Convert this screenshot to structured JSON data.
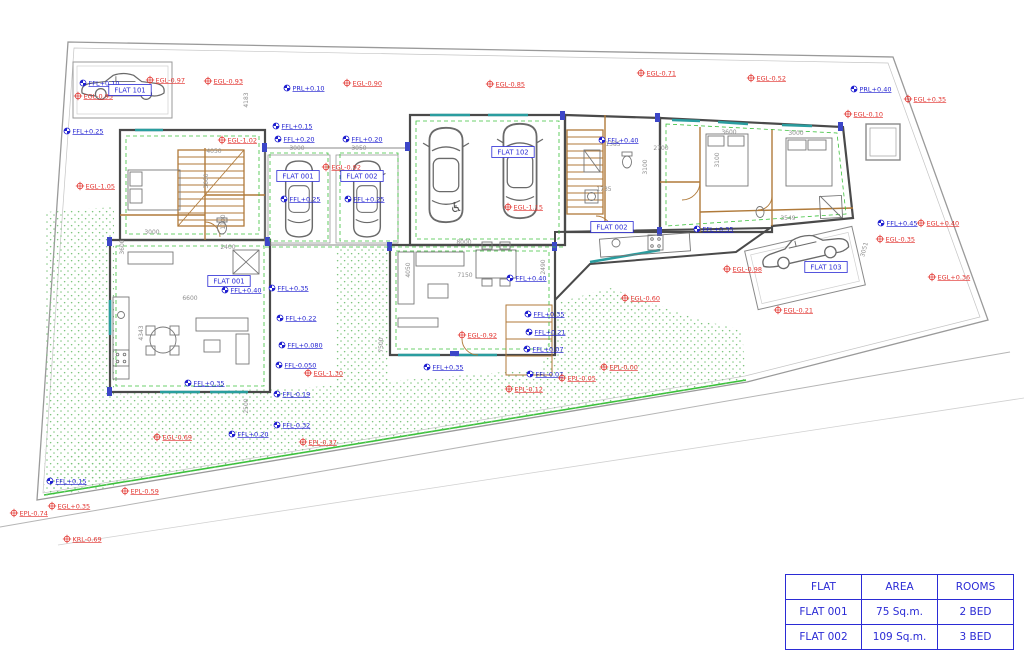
{
  "colors": {
    "marker_red": "#e23530",
    "marker_blue": "#1f1fd0",
    "tag_blue": "#2b2bd5",
    "dim_gray": "#8f8f8f",
    "wall": "#4a4a4a",
    "wood": "#b07a3a",
    "green": "#3cc13c",
    "teal": "#2a9d9f",
    "frame_blue": "#3c46c8",
    "stipple_green": "#7cc47c",
    "boundary_gray": "#9a9a9a",
    "furniture_gray": "#777777"
  },
  "markers": [
    {
      "x": 83,
      "y": 83,
      "label": "FFL+0.10",
      "type": "blue"
    },
    {
      "x": 150,
      "y": 80,
      "label": "EGL-0.97",
      "type": "red"
    },
    {
      "x": 208,
      "y": 81,
      "label": "EGL-0.93",
      "type": "red"
    },
    {
      "x": 78,
      "y": 96,
      "label": "EGL-0.95",
      "type": "red"
    },
    {
      "x": 287,
      "y": 88,
      "label": "PRL+0.10",
      "type": "blue"
    },
    {
      "x": 347,
      "y": 83,
      "label": "EGL-0.90",
      "type": "red"
    },
    {
      "x": 490,
      "y": 84,
      "label": "EGL-0.85",
      "type": "red"
    },
    {
      "x": 641,
      "y": 73,
      "label": "EGL-0.71",
      "type": "red"
    },
    {
      "x": 751,
      "y": 78,
      "label": "EGL-0.52",
      "type": "red"
    },
    {
      "x": 854,
      "y": 89,
      "label": "PRL+0.40",
      "type": "blue"
    },
    {
      "x": 908,
      "y": 99,
      "label": "EGL+0.35",
      "type": "red"
    },
    {
      "x": 848,
      "y": 114,
      "label": "EGL-0.10",
      "type": "red"
    },
    {
      "x": 67,
      "y": 131,
      "label": "FFL+0.25",
      "type": "blue"
    },
    {
      "x": 80,
      "y": 186,
      "label": "EGL-1.05",
      "type": "red"
    },
    {
      "x": 222,
      "y": 140,
      "label": "EGL-1.02",
      "type": "red"
    },
    {
      "x": 276,
      "y": 126,
      "label": "FFL+0.15",
      "type": "blue"
    },
    {
      "x": 278,
      "y": 139,
      "label": "FFL+0.20",
      "type": "blue"
    },
    {
      "x": 346,
      "y": 139,
      "label": "FFL+0.20",
      "type": "blue"
    },
    {
      "x": 326,
      "y": 167,
      "label": "EGL-0.92",
      "type": "red"
    },
    {
      "x": 284,
      "y": 199,
      "label": "FFL+0.25",
      "type": "blue"
    },
    {
      "x": 348,
      "y": 199,
      "label": "FFL+0.25",
      "type": "blue"
    },
    {
      "x": 508,
      "y": 207,
      "label": "EGL-1.15",
      "type": "red"
    },
    {
      "x": 602,
      "y": 140,
      "label": "FFL+0.40",
      "type": "blue"
    },
    {
      "x": 510,
      "y": 278,
      "label": "FFL+0.40",
      "type": "blue"
    },
    {
      "x": 272,
      "y": 288,
      "label": "FFL+0.35",
      "type": "blue"
    },
    {
      "x": 225,
      "y": 290,
      "label": "FFL+0.40",
      "type": "blue"
    },
    {
      "x": 280,
      "y": 318,
      "label": "FFL+0.22",
      "type": "blue"
    },
    {
      "x": 282,
      "y": 345,
      "label": "FFL+0.080",
      "type": "blue"
    },
    {
      "x": 279,
      "y": 365,
      "label": "FFL-0.050",
      "type": "blue"
    },
    {
      "x": 308,
      "y": 373,
      "label": "EGL-1.30",
      "type": "red"
    },
    {
      "x": 188,
      "y": 383,
      "label": "FFL+0.35",
      "type": "blue"
    },
    {
      "x": 277,
      "y": 394,
      "label": "FFL-0.19",
      "type": "blue"
    },
    {
      "x": 277,
      "y": 425,
      "label": "FFL-0.32",
      "type": "blue"
    },
    {
      "x": 303,
      "y": 442,
      "label": "EPL-0.37",
      "type": "red"
    },
    {
      "x": 232,
      "y": 434,
      "label": "FFL+0.20",
      "type": "blue"
    },
    {
      "x": 157,
      "y": 437,
      "label": "EGL-0.69",
      "type": "red"
    },
    {
      "x": 50,
      "y": 481,
      "label": "FFL+0.15",
      "type": "blue"
    },
    {
      "x": 52,
      "y": 506,
      "label": "EGL+0.35",
      "type": "red"
    },
    {
      "x": 14,
      "y": 513,
      "label": "EPL-0.74",
      "type": "red"
    },
    {
      "x": 125,
      "y": 491,
      "label": "EPL-0.59",
      "type": "red"
    },
    {
      "x": 67,
      "y": 539,
      "label": "KRL-0.69",
      "type": "red"
    },
    {
      "x": 427,
      "y": 367,
      "label": "FFL+0.35",
      "type": "blue"
    },
    {
      "x": 462,
      "y": 335,
      "label": "EGL-0.92",
      "type": "red"
    },
    {
      "x": 528,
      "y": 314,
      "label": "FFL+0.35",
      "type": "blue"
    },
    {
      "x": 529,
      "y": 332,
      "label": "FFL+0.21",
      "type": "blue"
    },
    {
      "x": 527,
      "y": 349,
      "label": "FFL+0.07",
      "type": "blue"
    },
    {
      "x": 530,
      "y": 374,
      "label": "FFL-0.07",
      "type": "blue"
    },
    {
      "x": 562,
      "y": 378,
      "label": "EPL-0.05",
      "type": "red"
    },
    {
      "x": 604,
      "y": 367,
      "label": "EPL-0.00",
      "type": "red"
    },
    {
      "x": 509,
      "y": 389,
      "label": "EPL-0.12",
      "type": "red"
    },
    {
      "x": 625,
      "y": 298,
      "label": "EGL-0.60",
      "type": "red"
    },
    {
      "x": 697,
      "y": 229,
      "label": "FFL+0.35",
      "type": "blue"
    },
    {
      "x": 881,
      "y": 223,
      "label": "FFL+0.45",
      "type": "blue"
    },
    {
      "x": 921,
      "y": 223,
      "label": "EGL+0.40",
      "type": "red"
    },
    {
      "x": 880,
      "y": 239,
      "label": "EGL-0.35",
      "type": "red"
    },
    {
      "x": 932,
      "y": 277,
      "label": "EGL+0.36",
      "type": "red"
    },
    {
      "x": 727,
      "y": 269,
      "label": "EGL-0.98",
      "type": "red"
    },
    {
      "x": 778,
      "y": 310,
      "label": "EGL-0.21",
      "type": "red"
    }
  ],
  "flat_tags": [
    {
      "x": 130,
      "y": 90,
      "label": "FLAT 101"
    },
    {
      "x": 298,
      "y": 176,
      "label": "FLAT 001"
    },
    {
      "x": 362,
      "y": 176,
      "label": "FLAT 002"
    },
    {
      "x": 513,
      "y": 152,
      "label": "FLAT 102"
    },
    {
      "x": 229,
      "y": 281,
      "label": "FLAT 001"
    },
    {
      "x": 612,
      "y": 227,
      "label": "FLAT 002"
    },
    {
      "x": 826,
      "y": 267,
      "label": "FLAT 103"
    }
  ],
  "dims": [
    {
      "x": 248,
      "y": 100,
      "label": "4183",
      "rot": 90
    },
    {
      "x": 214,
      "y": 153,
      "label": "4050",
      "rot": 0
    },
    {
      "x": 208,
      "y": 181,
      "label": "3600",
      "rot": 90
    },
    {
      "x": 297,
      "y": 150,
      "label": "3000",
      "rot": 0
    },
    {
      "x": 359,
      "y": 150,
      "label": "3050",
      "rot": 0
    },
    {
      "x": 152,
      "y": 234,
      "label": "3000",
      "rot": 0
    },
    {
      "x": 124,
      "y": 247,
      "label": "3600",
      "rot": 90
    },
    {
      "x": 143,
      "y": 333,
      "label": "4343",
      "rot": 90
    },
    {
      "x": 190,
      "y": 300,
      "label": "6600",
      "rot": 0
    },
    {
      "x": 228,
      "y": 249,
      "label": "2400",
      "rot": 0
    },
    {
      "x": 225,
      "y": 222,
      "label": "1100",
      "rot": 90
    },
    {
      "x": 464,
      "y": 244,
      "label": "8000",
      "rot": 0
    },
    {
      "x": 465,
      "y": 277,
      "label": "7150",
      "rot": 0
    },
    {
      "x": 410,
      "y": 270,
      "label": "4050",
      "rot": 90
    },
    {
      "x": 545,
      "y": 267,
      "label": "2490",
      "rot": 90
    },
    {
      "x": 383,
      "y": 345,
      "label": "7500",
      "rot": 90
    },
    {
      "x": 248,
      "y": 406,
      "label": "2500",
      "rot": 90
    },
    {
      "x": 613,
      "y": 146,
      "label": "1385",
      "rot": 0
    },
    {
      "x": 661,
      "y": 150,
      "label": "2700",
      "rot": 0
    },
    {
      "x": 647,
      "y": 167,
      "label": "3100",
      "rot": 90
    },
    {
      "x": 719,
      "y": 160,
      "label": "3100",
      "rot": 90
    },
    {
      "x": 729,
      "y": 134,
      "label": "3600",
      "rot": 0
    },
    {
      "x": 796,
      "y": 135,
      "label": "3000",
      "rot": 0
    },
    {
      "x": 788,
      "y": 220,
      "label": "3549",
      "rot": 0
    },
    {
      "x": 604,
      "y": 191,
      "label": "1735",
      "rot": 0
    },
    {
      "x": 866,
      "y": 250,
      "label": "3051",
      "rot": 75
    }
  ],
  "legend_table": {
    "headers": [
      "FLAT",
      "AREA",
      "ROOMS"
    ],
    "rows": [
      [
        "FLAT 001",
        "75 Sq.m.",
        "2 BED"
      ],
      [
        "FLAT 002",
        "109 Sq.m.",
        "3 BED"
      ]
    ]
  }
}
